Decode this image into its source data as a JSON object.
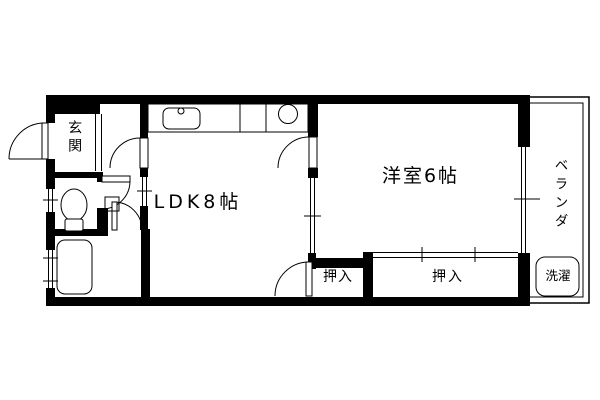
{
  "rooms": {
    "genkan": "玄関",
    "ldk": "LDK8帖",
    "western_room": "洋室6帖",
    "closet_small": "押入",
    "closet_large": "押入",
    "veranda": "ベランダ",
    "laundry": "洗濯"
  },
  "colors": {
    "wall": "#000000",
    "line": "#000000",
    "background": "#ffffff"
  }
}
